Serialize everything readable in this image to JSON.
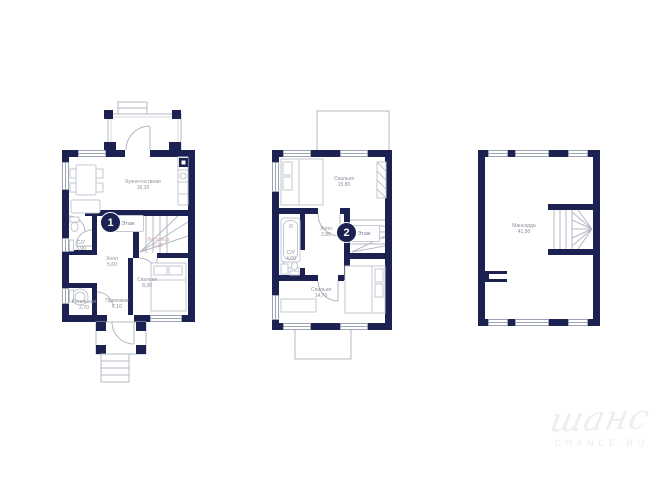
{
  "floors": [
    {
      "badge_number": "1",
      "badge_label": "Этаж",
      "rooms": [
        {
          "name": "Кухня-гостиная",
          "area": "16,10"
        },
        {
          "name": "С/У",
          "area": "3,90"
        },
        {
          "name": "Холл",
          "area": "5,60"
        },
        {
          "name": "Лестница",
          "area": "5,10"
        },
        {
          "name": "Спальня",
          "area": "8,30"
        },
        {
          "name": "Котельная",
          "area": "2,70"
        },
        {
          "name": "Прихожая",
          "area": "7,10"
        }
      ]
    },
    {
      "badge_number": "2",
      "badge_label": "Этаж",
      "rooms": [
        {
          "name": "Спальня",
          "area": "15,80"
        },
        {
          "name": "Холл",
          "area": "3,80"
        },
        {
          "name": "С/У",
          "area": "4,60"
        },
        {
          "name": "Спальня",
          "area": "14,70"
        }
      ]
    },
    {
      "rooms": [
        {
          "name": "Мансарда",
          "area": "41,50"
        }
      ]
    }
  ],
  "watermark": {
    "logo_text": "шанс",
    "site_text": "CHANCE.RU"
  },
  "colors": {
    "wall": "#1b2150",
    "outline": "#b4b8c4",
    "furniture": "#c3c7d1",
    "label_text": "#8b8f99",
    "stairs_label_text": "#d4aaa6",
    "watermark": "#edeef2"
  }
}
